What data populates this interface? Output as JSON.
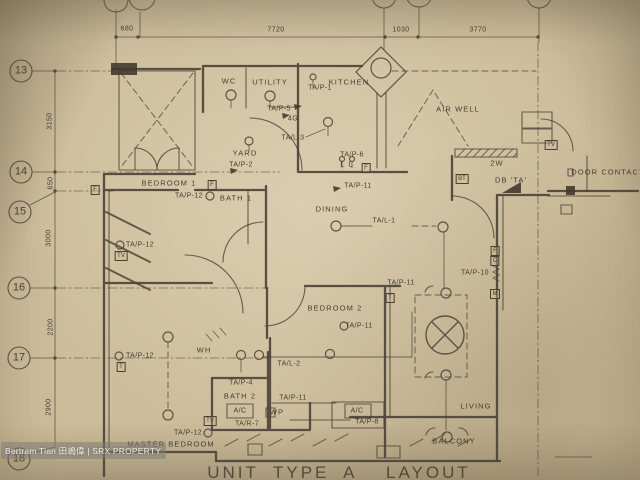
{
  "plan": {
    "title": "UNIT TYPE A  LAYOUT",
    "watermark": "Bertram Tian 田嶋偉 | SRX PROPERTY",
    "grid_numbers": [
      {
        "t": "13",
        "x": 21,
        "y": 71
      },
      {
        "t": "14",
        "x": 21,
        "y": 172
      },
      {
        "t": "15",
        "x": 20,
        "y": 212
      },
      {
        "t": "16",
        "x": 19,
        "y": 288
      },
      {
        "t": "17",
        "x": 19,
        "y": 358
      },
      {
        "t": "18",
        "x": 19,
        "y": 459
      }
    ],
    "dims_top": [
      {
        "t": "680",
        "x": 127,
        "y": 29
      },
      {
        "t": "7720",
        "x": 276,
        "y": 30
      },
      {
        "t": "1030",
        "x": 401,
        "y": 30
      },
      {
        "t": "3770",
        "x": 478,
        "y": 30
      }
    ],
    "dims_left": [
      {
        "t": "3150",
        "x": 50,
        "y": 121
      },
      {
        "t": "650",
        "x": 51,
        "y": 183
      },
      {
        "t": "3000",
        "x": 49,
        "y": 238
      },
      {
        "t": "2200",
        "x": 51,
        "y": 327
      },
      {
        "t": "2900",
        "x": 49,
        "y": 407
      }
    ],
    "rooms": [
      {
        "t": "WC",
        "x": 229,
        "y": 81
      },
      {
        "t": "UTILITY",
        "x": 270,
        "y": 82
      },
      {
        "t": "KITCHEN",
        "x": 349,
        "y": 82
      },
      {
        "t": "AIR WELL",
        "x": 458,
        "y": 109
      },
      {
        "t": "YARD",
        "x": 245,
        "y": 153
      },
      {
        "t": "BEDROOM 1",
        "x": 169,
        "y": 183
      },
      {
        "t": "BATH 1",
        "x": 236,
        "y": 198
      },
      {
        "t": "DINING",
        "x": 332,
        "y": 209
      },
      {
        "t": "BEDROOM 2",
        "x": 335,
        "y": 308
      },
      {
        "t": "LIVING",
        "x": 476,
        "y": 406
      },
      {
        "t": "BALCONY",
        "x": 454,
        "y": 441
      },
      {
        "t": "BATH 2",
        "x": 240,
        "y": 396
      },
      {
        "t": "MASTER BEDROOM",
        "x": 171,
        "y": 444
      },
      {
        "t": "WH",
        "x": 204,
        "y": 350
      },
      {
        "t": "WP",
        "x": 277,
        "y": 412
      },
      {
        "t": "DOOR CONTACT",
        "x": 608,
        "y": 172
      },
      {
        "t": "DB 'TA'",
        "x": 511,
        "y": 180
      },
      {
        "t": "2W",
        "x": 497,
        "y": 163
      },
      {
        "t": "L L",
        "x": 347,
        "y": 164
      }
    ],
    "electrical": [
      {
        "t": "TA/P-1",
        "x": 320,
        "y": 88
      },
      {
        "t": "TA/P-5",
        "x": 279,
        "y": 109
      },
      {
        "t": "4G",
        "x": 293,
        "y": 119
      },
      {
        "t": "TA/L-3",
        "x": 293,
        "y": 138
      },
      {
        "t": "TA/P-2",
        "x": 241,
        "y": 165
      },
      {
        "t": "TA/P-6",
        "x": 352,
        "y": 155
      },
      {
        "t": "TA/P-11",
        "x": 358,
        "y": 186
      },
      {
        "t": "TA/P-12",
        "x": 189,
        "y": 196
      },
      {
        "t": "TA/L-1",
        "x": 384,
        "y": 221
      },
      {
        "t": "TA/P-12",
        "x": 140,
        "y": 245
      },
      {
        "t": "TA/P-12",
        "x": 140,
        "y": 356
      },
      {
        "t": "TA/P-11",
        "x": 401,
        "y": 283
      },
      {
        "t": "TA/P-10",
        "x": 475,
        "y": 273
      },
      {
        "t": "TA/P-11",
        "x": 359,
        "y": 326
      },
      {
        "t": "TA/L-2",
        "x": 289,
        "y": 364
      },
      {
        "t": "TA/P-4",
        "x": 241,
        "y": 383
      },
      {
        "t": "TA/P-11",
        "x": 293,
        "y": 398
      },
      {
        "t": "A/C",
        "x": 240,
        "y": 411
      },
      {
        "t": "TA/R-7",
        "x": 247,
        "y": 424
      },
      {
        "t": "A/C",
        "x": 357,
        "y": 411
      },
      {
        "t": "TA/P-8",
        "x": 367,
        "y": 422
      },
      {
        "t": "TA/P-12",
        "x": 188,
        "y": 433
      }
    ],
    "boxes": [
      {
        "t": "F",
        "x": 212,
        "y": 185
      },
      {
        "t": "TV",
        "x": 121,
        "y": 256
      },
      {
        "t": "T",
        "x": 121,
        "y": 367
      },
      {
        "t": "TV",
        "x": 210,
        "y": 421
      },
      {
        "t": "BT",
        "x": 462,
        "y": 179
      },
      {
        "t": "F",
        "x": 366,
        "y": 168
      },
      {
        "t": "F",
        "x": 495,
        "y": 251
      },
      {
        "t": "C",
        "x": 495,
        "y": 261
      },
      {
        "t": "M",
        "x": 495,
        "y": 294
      },
      {
        "t": "T",
        "x": 390,
        "y": 298
      },
      {
        "t": "TV",
        "x": 551,
        "y": 145
      },
      {
        "t": "F",
        "x": 95,
        "y": 190
      }
    ]
  }
}
